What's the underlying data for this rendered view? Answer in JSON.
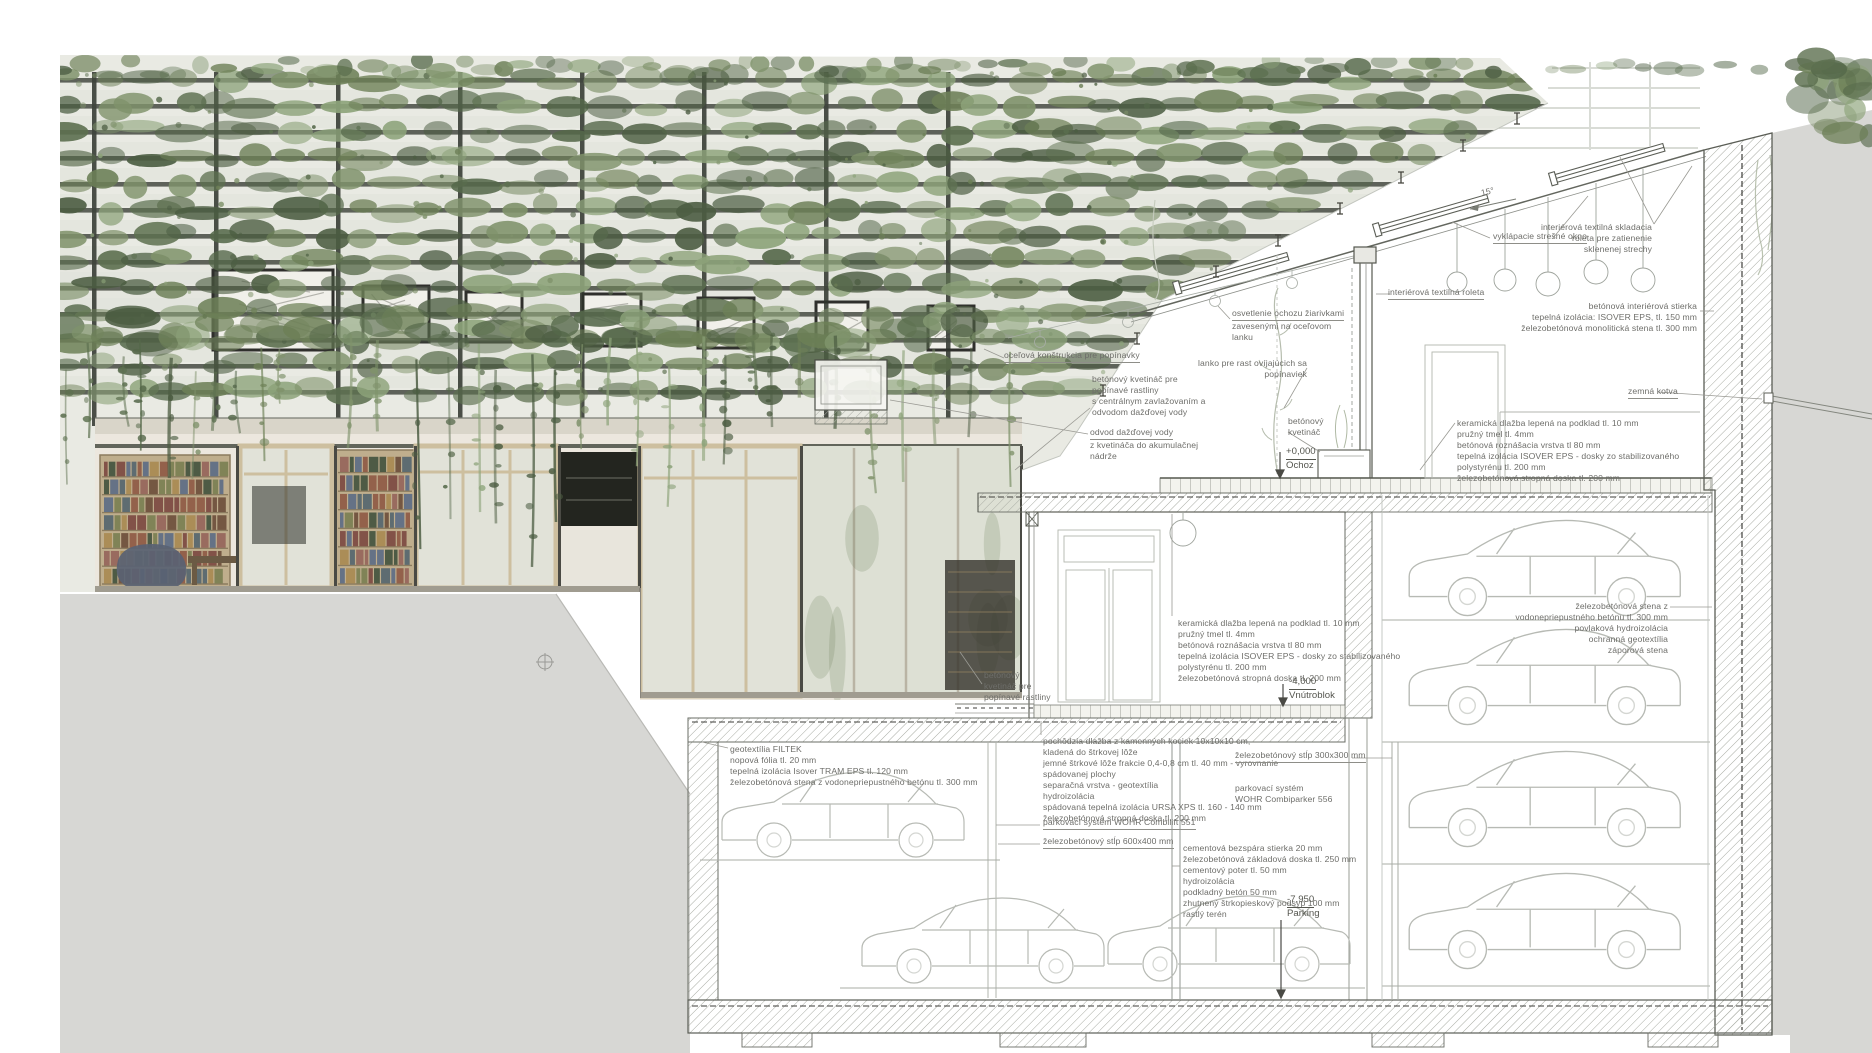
{
  "drawing": {
    "type": "architectural cross-section with green facade elevation",
    "language": "Slovak",
    "roof_slope_deg": "15°"
  },
  "palette": {
    "page_bg": "#ffffff",
    "terrain_gray": "#d7d7d4",
    "line_dark": "#55584f",
    "line_light": "#b3b6af",
    "hatch_gray": "#a8aba3",
    "text_gray": "#6e6e6a",
    "green_dark": "#4c5d42",
    "green_mid": "#6d8057",
    "green_light": "#8da37a",
    "slat_dark": "#3f443c",
    "wood_frame": "#cdbf9f",
    "glass": "#e1e2d8"
  },
  "level_markers": [
    {
      "name": "level-ochoz",
      "value": "+0,000",
      "label": "Ochoz",
      "x": 1286,
      "y": 446
    },
    {
      "name": "level-vnutroblok",
      "value": "-4,000",
      "label": "Vnútroblok",
      "x": 1289,
      "y": 676
    },
    {
      "name": "level-parking",
      "value": "-7,950",
      "label": "Parking",
      "x": 1287,
      "y": 894
    }
  ],
  "annotations": [
    {
      "name": "roof-slope-angle",
      "x": 1480,
      "y": 188,
      "rot": -13,
      "lines": [
        "15°"
      ]
    },
    {
      "name": "vyklapacie-stresne-okno",
      "x": 1493,
      "y": 231,
      "u": true,
      "lines": [
        "vyklápacie strešné okno"
      ]
    },
    {
      "name": "interierova-textilna-skladacia-roleta",
      "x": 1652,
      "y": 222,
      "align": "right",
      "lines": [
        "interiérová textilná skladacia",
        "roleta pre zatienenie",
        "sklenenej strechy"
      ]
    },
    {
      "name": "interierova-textilna-roleta",
      "x": 1388,
      "y": 287,
      "u": true,
      "lines": [
        "interiérová textilná roleta"
      ]
    },
    {
      "name": "betonova-interierova-stierka",
      "x": 1697,
      "y": 301,
      "align": "right",
      "lines": [
        "betónová interiérová stierka",
        "tepelná izolácia: ISOVER EPS, tl. 150 mm",
        "železobetónová monolitická stena tl. 300 mm"
      ]
    },
    {
      "name": "osvetlenie-ochozu",
      "x": 1232,
      "y": 308,
      "u": true,
      "lines": [
        "osvetlenie ochozu žiarivkami",
        "zavesenými na oceľovom",
        "lanku"
      ]
    },
    {
      "name": "ocelova-konstrukcia-pre-popinavky",
      "x": 1004,
      "y": 350,
      "u": true,
      "lines": [
        "oceľová konštrukcia pre popínavky"
      ]
    },
    {
      "name": "lanko-pre-rast-popinaviek",
      "x": 1307,
      "y": 358,
      "align": "right",
      "lines": [
        "lanko pre rast ovíjajúcich sa",
        "popínaviek"
      ]
    },
    {
      "name": "betonovy-kvetinac-pre-rastliny",
      "x": 1092,
      "y": 374,
      "lines": [
        "betónový kvetináč pre",
        "popínavé rastliny",
        "s centrálnym zavlažovaním a",
        "odvodom dažďovej vody"
      ]
    },
    {
      "name": "zemna-kotva",
      "x": 1628,
      "y": 386,
      "u": true,
      "lines": [
        "zemná kotva"
      ]
    },
    {
      "name": "betonovy-kvetinac-ochoz",
      "x": 1288,
      "y": 416,
      "lines": [
        "betónový",
        "kvetináč"
      ]
    },
    {
      "name": "skladba-podlahy-ochoz",
      "x": 1457,
      "y": 418,
      "lines": [
        "keramická dlažba lepená na podklad tl. 10 mm",
        "pružný tmel tl. 4mm",
        "betónová roznášacia vrstva tl 80 mm",
        "tepelná izolácia ISOVER EPS - dosky zo stabilizovaného",
        "polystyrénu tl. 200 mm",
        "železobetónová stropná doska tl. 200 mm"
      ]
    },
    {
      "name": "odvod-dazdovej-vody",
      "x": 1090,
      "y": 427,
      "u": true,
      "lines": [
        "odvod dažďovej vody",
        "z kvetináča do akumulačnej",
        "nádrže"
      ]
    },
    {
      "name": "skladba-podlahy-interier",
      "x": 1178,
      "y": 618,
      "lines": [
        "keramická dlažba lepená na podklad tl. 10 mm",
        "pružný tmel tl. 4mm",
        "betónová roznášacia vrstva tl 80 mm",
        "tepelná izolácia ISOVER EPS - dosky zo stabilizovaného",
        "polystyrénu tl. 200 mm",
        "železobetónová stropná doska tl. 200 mm"
      ]
    },
    {
      "name": "zelezobetonova-stena-vpravo",
      "x": 1668,
      "y": 601,
      "align": "right",
      "lines": [
        "železobetónová stena z",
        "vodonepriepustného betónu tl. 300 mm",
        "povlaková hydroizolácia",
        "ochranná geotextília",
        "záporová stena"
      ]
    },
    {
      "name": "betonovy-kvetinac-vnutroblok",
      "x": 984,
      "y": 670,
      "lines": [
        "betónový",
        "kvetináč pre",
        "popínavé rastliny"
      ]
    },
    {
      "name": "geotextilia-filtek",
      "x": 730,
      "y": 744,
      "lines": [
        "geotextília FILTEK",
        "nopová fólia tl. 20 mm",
        "tepelná izolácia Isover TRAM EPS tl. 120 mm",
        "železobetónová stena z vodonepriepustného betónu tl. 300 mm"
      ]
    },
    {
      "name": "pochodzia-dlazba",
      "x": 1043,
      "y": 736,
      "lines": [
        "pochôdzia dlažba z kamenných kociek 10x10x10 cm,",
        "kladená do štrkovej lôže",
        "jemné štrkové lôže frakcie 0,4-0,8 cm tl. 40 mm - vyrovnanie",
        "spádovanej plochy",
        "separačná vrstva - geotextília",
        "hydroizolácia",
        "spádovaná tepelná izolácia URSA XPS tl. 160 - 140 mm",
        "železobetónová stropná doska tl. 200 mm"
      ]
    },
    {
      "name": "zelezobetonovy-stlp-300",
      "x": 1235,
      "y": 750,
      "u": true,
      "lines": [
        "železobetónový stĺp 300x300 mm"
      ]
    },
    {
      "name": "parkovaci-system-combiparker",
      "x": 1235,
      "y": 783,
      "lines": [
        "parkovací systém",
        "WOHR Combiparker 556"
      ]
    },
    {
      "name": "parkovaci-system-combilift",
      "x": 1043,
      "y": 817,
      "u": true,
      "lines": [
        "parkovací systém WOHR Combilift 551"
      ]
    },
    {
      "name": "zelezobetonovy-stlp-600",
      "x": 1043,
      "y": 836,
      "u": true,
      "lines": [
        "železobetónový stĺp 600x400 mm"
      ]
    },
    {
      "name": "skladba-zakladovej-dosky",
      "x": 1183,
      "y": 843,
      "lines": [
        "cementová bezspára stierka 20 mm",
        "železobetónová základová doska tl. 250 mm",
        "cementový poter tl. 50 mm",
        "hydroizolácia",
        "podkladný betón 50 mm",
        "zhutnený štrkopieskový podsyp 100 mm",
        "rastlý terén"
      ]
    }
  ]
}
